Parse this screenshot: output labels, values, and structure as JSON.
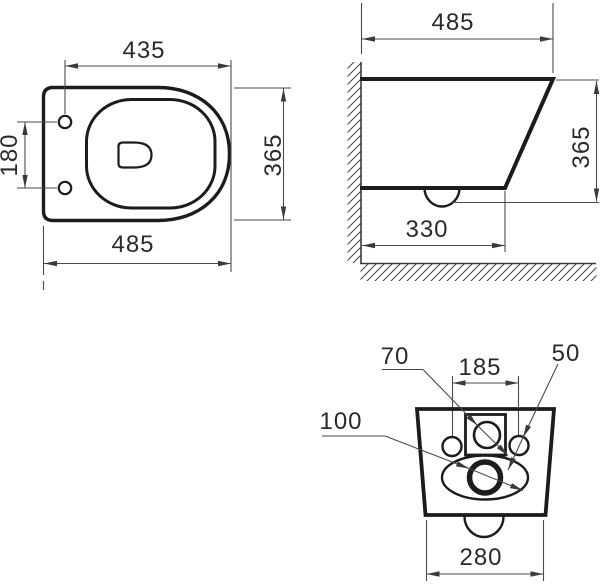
{
  "drawing": {
    "description": "wall-hung toilet dimension drawing, three views",
    "colors": {
      "outline": "#1c1c1c",
      "dimension_lines": "#4a4a4a",
      "background": "#ffffff"
    },
    "views": {
      "top_view": {
        "dim_holes_to_front": "435",
        "dim_hole_spacing": "180",
        "dim_depth": "365",
        "dim_total_length": "485"
      },
      "side_view": {
        "dim_total_length": "485",
        "dim_height": "365",
        "dim_bottom_length": "330"
      },
      "back_view": {
        "dim_inlet_diameter": "70",
        "dim_hole_spacing": "185",
        "dim_fixing_hole_diameter": "50",
        "dim_outlet_diameter": "100",
        "dim_width": "280"
      }
    }
  }
}
